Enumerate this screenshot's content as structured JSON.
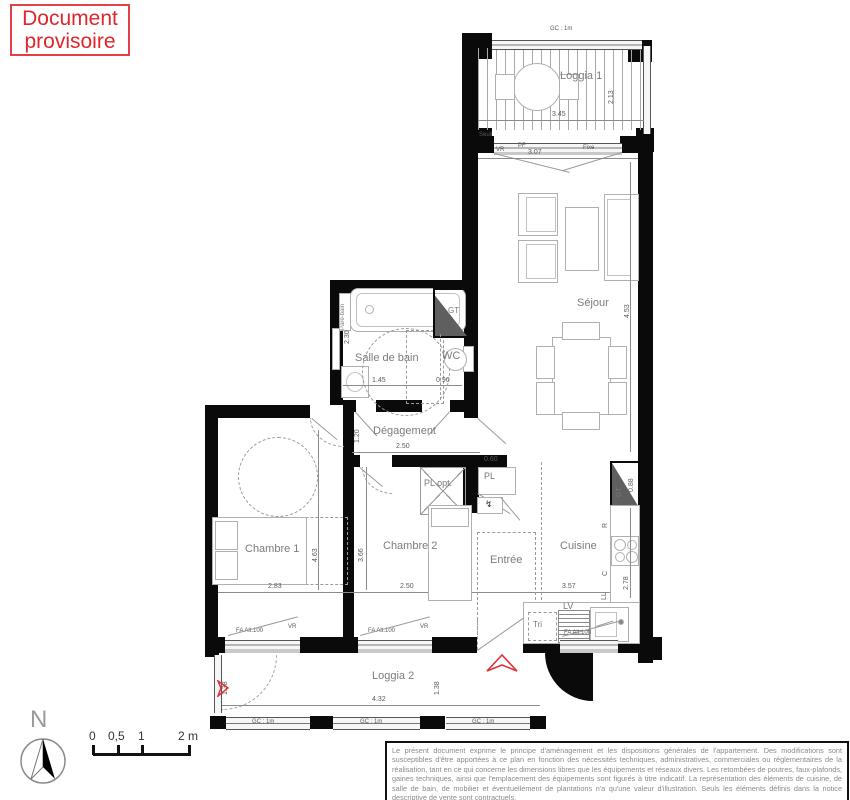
{
  "badge": {
    "label": "Document provisoire"
  },
  "rooms": {
    "loggia1": "Loggia 1",
    "sejour": "Séjour",
    "sdb": "Salle de bain",
    "wc": "WC",
    "degagement": "Dégagement",
    "chambre1": "Chambre 1",
    "chambre2": "Chambre 2",
    "entree": "Entrée",
    "cuisine": "Cuisine",
    "loggia2": "Loggia 2"
  },
  "closets": {
    "pl_opt": "PL opt.",
    "pl": "PL"
  },
  "appliances": {
    "fridge": "R",
    "hob": "C",
    "washer": "LL",
    "dishwasher": "LV",
    "waste_sorting": "Tri",
    "duct": "GT",
    "elec_panel": "↯"
  },
  "fixtures": {
    "bath_screen": "Pare-bain"
  },
  "openings": {
    "roller_shutter": "VR",
    "french_door": "PF",
    "fixed_pane": "Fixe",
    "window_type": "FA  Alt.100",
    "guardrail": "GC : 1m",
    "threshold": "Seuil"
  },
  "dims": {
    "loggia1_w": "3.45",
    "loggia1_h": "2.13",
    "sejour_window": "3.07",
    "sejour_h": "4.53",
    "sdb_w": "1.45",
    "wc_w": "0.96",
    "sdb_h": "2.30",
    "degagement_w": "2.50",
    "degagement_h": "1.20",
    "chambre1_w": "2.83",
    "chambre1_h": "4.63",
    "chambre2_w": "2.50",
    "chambre2_h": "3.66",
    "cuisine_w": "3.57",
    "cuisine_h": "2.78",
    "gt_h": "0.88",
    "pl_w": "0.60",
    "loggia2_w": "4.32",
    "loggia2_h": "1.38"
  },
  "compass": {
    "north": "N"
  },
  "scale": {
    "t0": "0",
    "t05": "0,5",
    "t1": "1",
    "t2": "2 m"
  },
  "disclaimer": "Le présent document exprime le principe d'aménagement et les dispositions générales de l'appartement. Des modifications sont susceptibles d'être apportées à ce plan en fonction des nécessités techniques, administratives, commerciales ou réglementaires de la réalisation, tant en ce qui concerne les dimensions libres que les équipements et réseaux divers. Les retombées de poutres, faux-plafonds, gaines techniques, ainsi que l'emplacement des équipements sont figurés à titre indicatif. La représentation des éléments de cuisine, de salle de bain, de mobilier et éventuellement de plantations n'a qu'une valeur d'illustration. Seuls les éléments définis dans la notice descriptive de vente sont contractuels.",
  "colors": {
    "accent_red": "#e03238",
    "wall": "#0a0a0a"
  }
}
